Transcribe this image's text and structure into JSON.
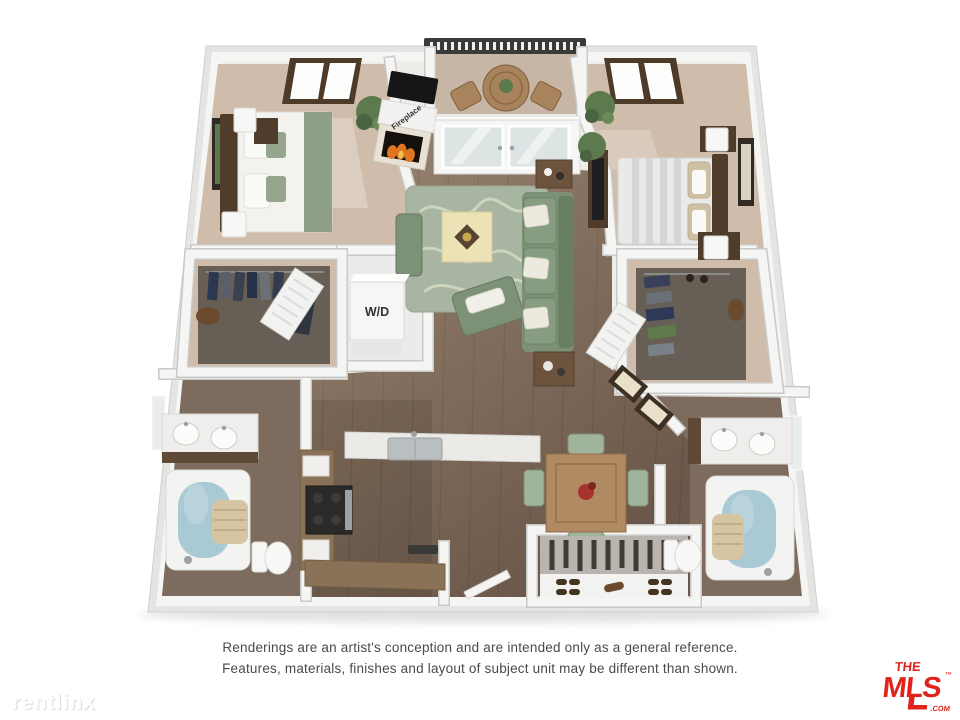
{
  "palette": {
    "slab_side": "#e4e4e2",
    "wall_face": "#f5f5f4",
    "wall_edge": "#c9c9c7",
    "floor_underlay": "#efede9",
    "carpet": "#cfbcaa",
    "balcony_floor": "#c7b6a5",
    "wood_light": "#9c8672",
    "wood_dark": "#6b584a",
    "rug_green": "#a7b5a2",
    "rug_pattern": "#d7dac2",
    "sofa_green": "#7c9176",
    "sofa_dark": "#687f62",
    "cream": "#ebe2b6",
    "furniture_wood": "#a9835c",
    "dark_wood": "#503c2a",
    "water_blue": "#a9c9d4",
    "towel_tan": "#d5c5a3",
    "closet_interior": "#675e55",
    "bath_floor": "#7d6b5d",
    "appliance_dark": "#2b2a29",
    "steel_gray": "#9aa0a3",
    "flame_orange": "#e0761f",
    "label_dark": "#323232",
    "disclaimer_text": "#4a4a4a",
    "mls_red": "#e0241c",
    "watermark_shadow": "#d9d9d9"
  },
  "floorplan": {
    "wd_label": "W/D",
    "fireplace_label": "Fireplace"
  },
  "disclaimer": {
    "line1": "Renderings are an artist's conception and are intended only as a general reference.",
    "line2": "Features, materials, finishes and layout of subject unit may be different than shown."
  },
  "watermark": {
    "text": "rentlinx"
  },
  "mls_logo": {
    "the": "THE",
    "mls": "MLS",
    "tm": "™",
    "com": ".COM"
  }
}
